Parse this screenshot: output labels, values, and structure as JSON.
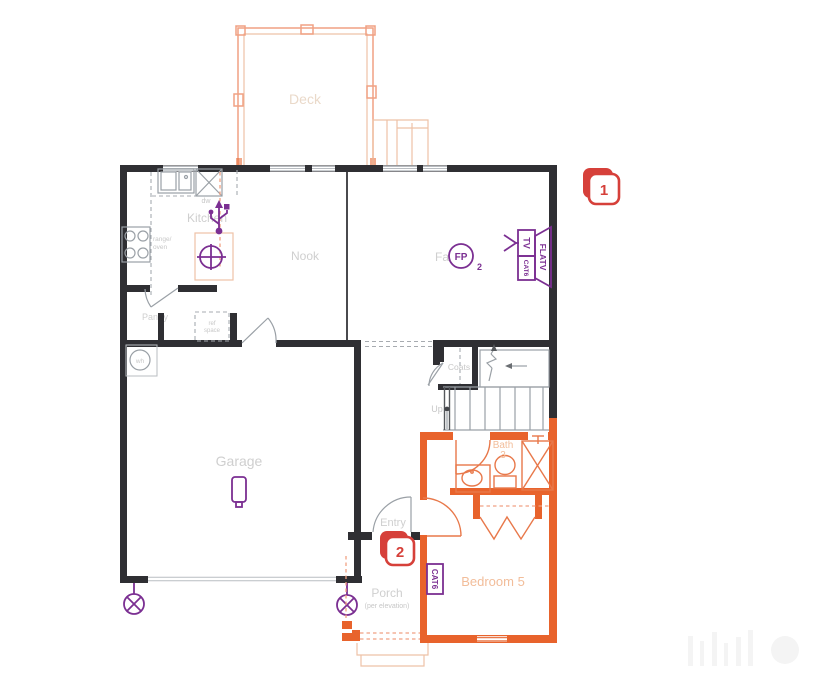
{
  "drawing": {
    "rooms": {
      "deck": "Deck",
      "kitchen": "Kitchen",
      "nook": "Nook",
      "family_fragment": "Fa",
      "pantry": "Pantry",
      "coats": "Coats",
      "garage": "Garage",
      "entry": "Entry",
      "porch": "Porch",
      "porch_note": "(per elevation)",
      "bath": "Bath",
      "bath_number": "3",
      "bedroom": "Bedroom 5",
      "stairs_up": "Up"
    },
    "fixtures": {
      "dishwasher": "dw",
      "water_heater": "wh",
      "range_line1": "range/",
      "range_line2": "oven",
      "fridge_line1": "ref",
      "fridge_line2": "space"
    },
    "electrical": {
      "fireplace": "FP",
      "fireplace_sub": "2",
      "tv": "TV",
      "cat6": "CAT6",
      "flatv": "FLATV",
      "bedroom_cat6": "CAT6"
    },
    "markers": {
      "marker1": "1",
      "marker2": "2"
    },
    "colors": {
      "wall": "#2f2f33",
      "highlight_orange": "#e8632c",
      "deck_orange": "#f0a183",
      "symbol_purple": "#7b2f92",
      "marker_red": "#d6403a"
    }
  }
}
